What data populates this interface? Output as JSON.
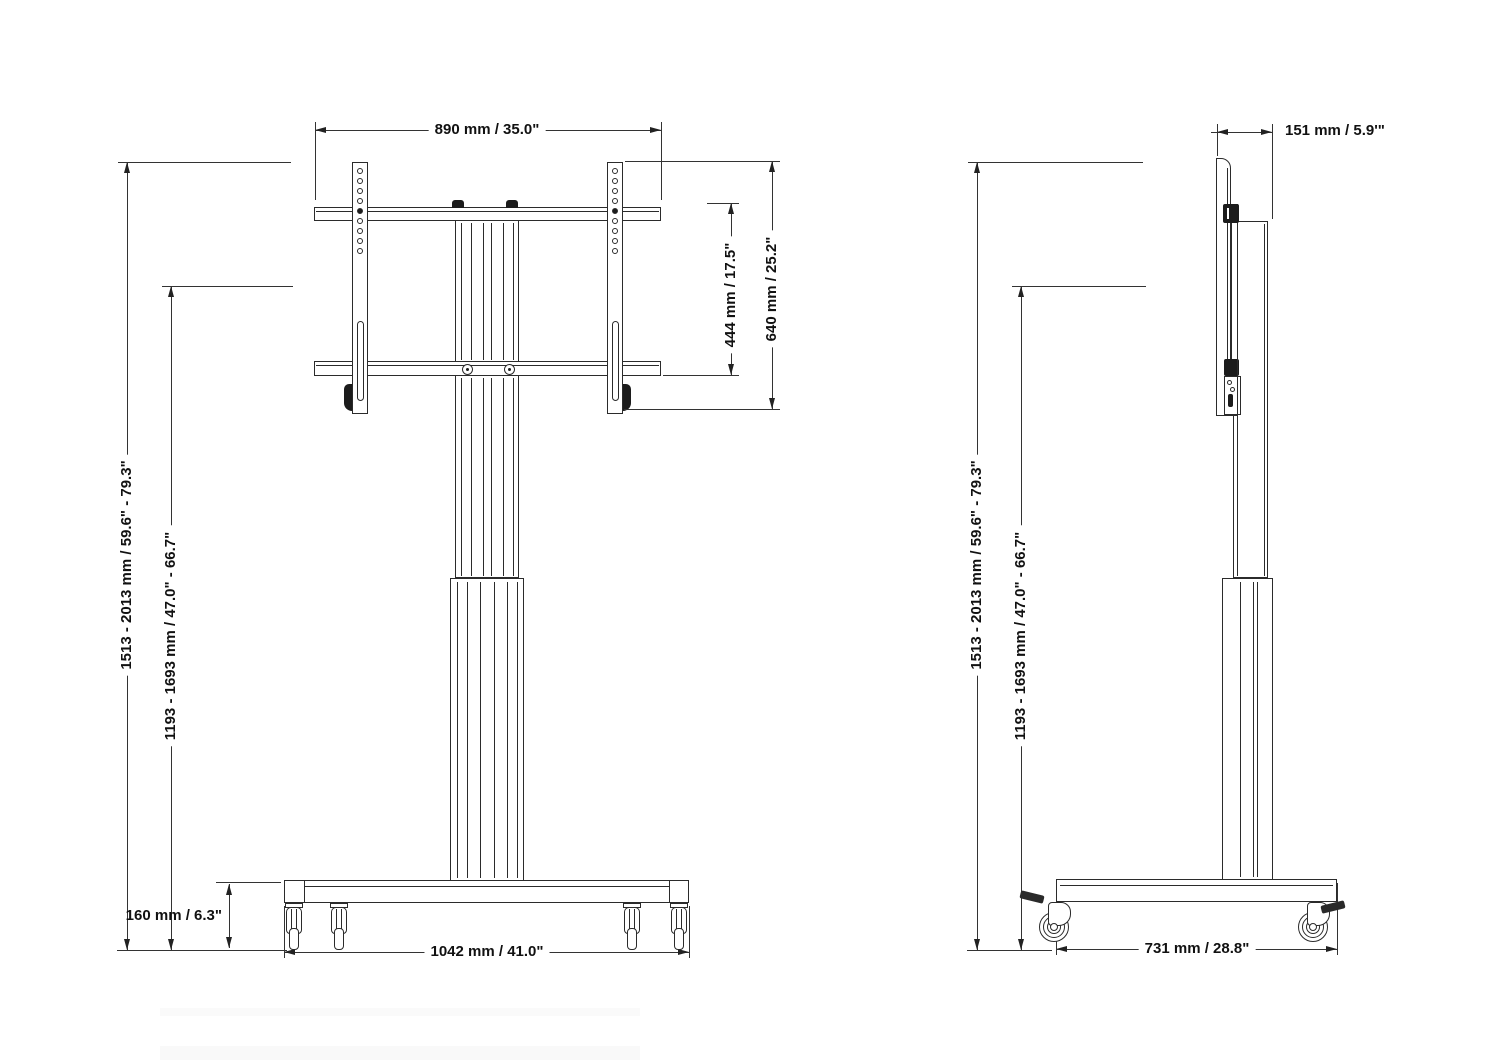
{
  "diagram": {
    "title": "tv-trolley-dimension-drawing",
    "front_view": {
      "dims": {
        "top_width": "890 mm / 35.0\"",
        "bracket_height": "444 mm / 17.5\"",
        "mount_height": "640 mm / 25.2\"",
        "overall_height_range": "1513 - 2013 mm / 59.6\" - 79.3\"",
        "center_height_range": "1193 - 1693 mm / 47.0\" - 66.7\"",
        "base_height": "160 mm / 6.3\"",
        "base_width": "1042 mm / 41.0\""
      }
    },
    "side_view": {
      "dims": {
        "depth_top": "151 mm / 5.9'\"",
        "overall_height_range": "1513 - 2013 mm / 59.6\" - 79.3\"",
        "center_height_range": "1193 - 1693 mm / 47.0\" - 66.7\"",
        "base_depth": "731 mm / 28.8\""
      }
    },
    "colors": {
      "line": "#2b2b2b",
      "text": "#111111",
      "background": "#ffffff"
    }
  }
}
